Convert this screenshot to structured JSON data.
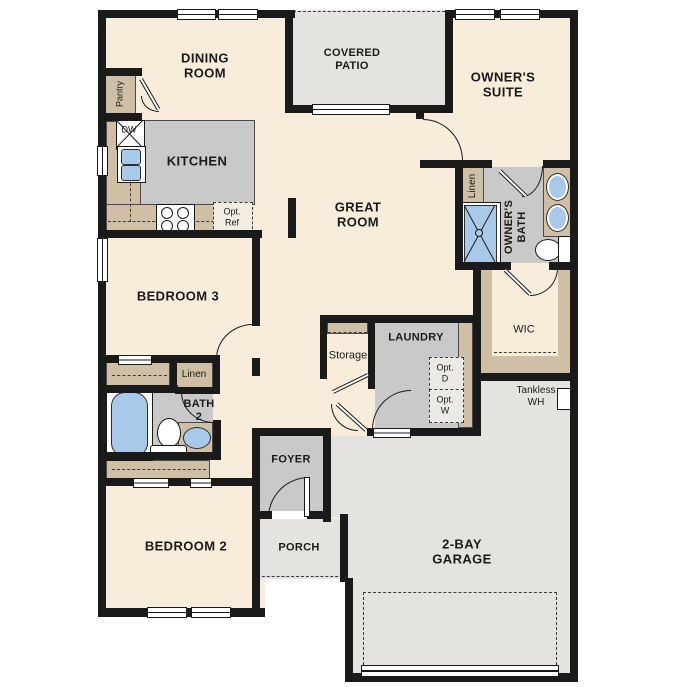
{
  "title": "single-story floor plan",
  "labels": {
    "dining_room": "DINING\nROOM",
    "covered_patio": "COVERED\nPATIO",
    "owners_suite": "OWNER'S\nSUITE",
    "kitchen": "KITCHEN",
    "great_room": "GREAT\nROOM",
    "bedroom3": "BEDROOM 3",
    "bedroom2": "BEDROOM 2",
    "garage": "2-BAY\nGARAGE",
    "laundry": "LAUNDRY",
    "foyer": "FOYER",
    "porch": "PORCH",
    "bath2": "BATH\n2",
    "owners_bath": "OWNER'S\nBATH",
    "wic": "WIC",
    "storage": "Storage",
    "linen_hall": "Linen",
    "linen_owners": "Linen",
    "pantry": "Pantry",
    "dw": "DW",
    "opt_ref": "Opt.\nRef",
    "opt_d": "Opt.\nD",
    "opt_w": "Opt.\nW",
    "tankless_wh": "Tankless\nWH"
  },
  "palette": {
    "wall": "#1a1a1a",
    "floor_cream": "#f8eddb",
    "exterior_gray": "#e4e3df",
    "room_gray": "#c9c9c9",
    "cabinet_tan": "#cfc0a5",
    "fixture_blue": "#a9c9ea",
    "background": "#ffffff"
  },
  "fixtures": [
    "dishwasher",
    "kitchen-sink",
    "range",
    "optional-refrigerator",
    "bathtub",
    "toilet",
    "vanity-sink",
    "shower",
    "double-vanity-sinks",
    "tankless-water-heater",
    "garage-door",
    "windows",
    "sliding-patio-door"
  ]
}
